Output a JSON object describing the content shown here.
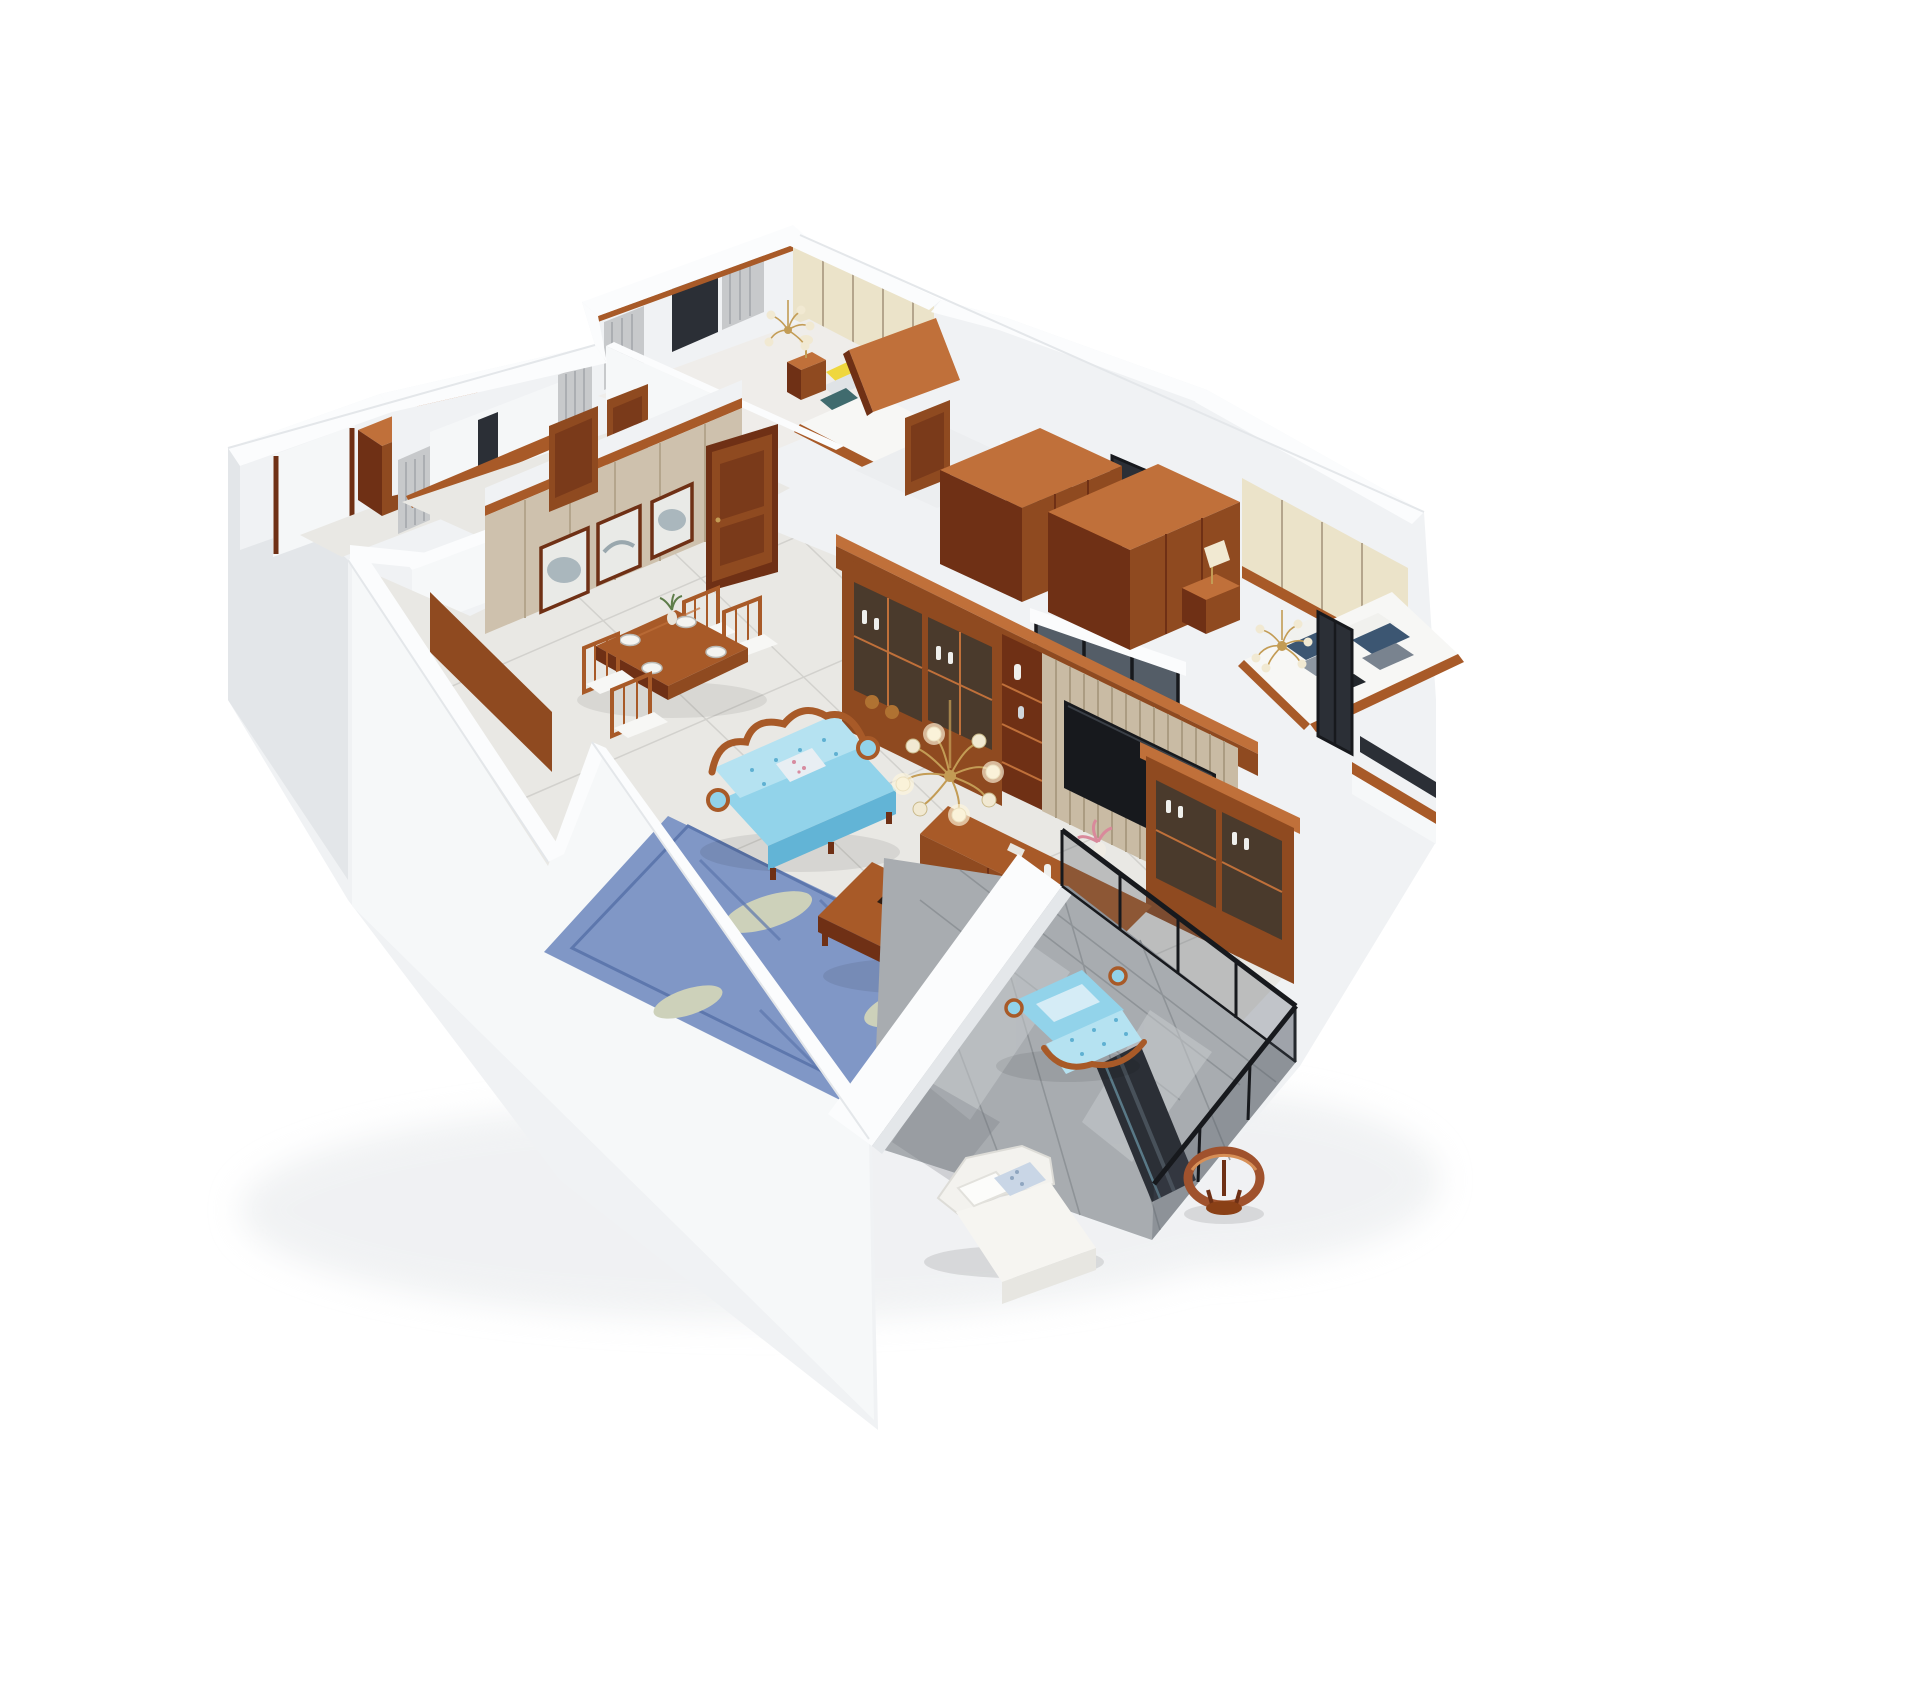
{
  "image_type": "3d-dollhouse-floorplan-render",
  "colors": {
    "bg": "#ffffff",
    "wallFace": "#f0f2f4",
    "wallFaceBright": "#f6f8f9",
    "wallShade": "#e3e6e9",
    "wallDark": "#d5d9dc",
    "cap": "#fbfcfd",
    "capEdge": "#e4e7ea",
    "floorLight": "#e9e8e4",
    "floorWarm": "#efedea",
    "tileLine": "#d2d1cd",
    "balconyTile": "#a8acb0",
    "balconyTileDark": "#888d92",
    "balconyTileLight": "#c9cdd0",
    "woodDark": "#6f3015",
    "wood": "#8f4a20",
    "woodMid": "#a85a28",
    "woodLight": "#c0703a",
    "woodPale": "#d79057",
    "panelBeige": "#cec1ad",
    "panelBeigeDark": "#b4a58c",
    "slat": "#c9bba4",
    "slatLine": "#ab9c82",
    "cream": "#ebe3c9",
    "curtain": "#c7c9cb",
    "curtainDark": "#abaeb2",
    "glassBright": "#f5f7f8",
    "glassDark": "#2b2f36",
    "glassTint": "#47505a",
    "black": "#17191d",
    "sofaBlue": "#92d3ea",
    "sofaBlueLight": "#b5e2f1",
    "sofaBlueDark": "#62b4d6",
    "rugBlue": "#8097c6",
    "rugBlueDark": "#5d77ad",
    "rugLeaf": "#cdd1ba",
    "white": "#f7f7f5",
    "pillowNavy": "#3c5672",
    "pillowGray": "#8d97a2",
    "pillowYellow": "#efd73e",
    "pillowTeal": "#406b6e",
    "gold": "#c39c55",
    "lampCream": "#f1e9d2",
    "artMist": "#aab7bd",
    "plantGreen": "#5e7d4a",
    "pink": "#d9899b",
    "shadow": "#e2e5e8"
  },
  "scene": {
    "style": "american-classic-wood-interior",
    "rooms": [
      {
        "id": "bedroom-north",
        "furniture": [
          "double-bed",
          "yellow-pillow",
          "nightstand",
          "table-lamp",
          "chandelier",
          "wardrobe-top",
          "window",
          "curtains",
          "cream-panel-wall"
        ]
      },
      {
        "id": "bedroom-west",
        "furniture": [
          "window",
          "curtains",
          "wood-window-sill"
        ]
      },
      {
        "id": "west-balcony",
        "furniture": [
          "wall-cabinet",
          "bright-window"
        ]
      },
      {
        "id": "hallway",
        "furniture": [
          "wood-door-bedroom",
          "wood-door-dining"
        ]
      },
      {
        "id": "bathroom-a",
        "furniture": [
          "glass-partition"
        ]
      },
      {
        "id": "bathroom-b",
        "furniture": [
          "glass-partition",
          "small-window"
        ]
      },
      {
        "id": "master-bedroom",
        "furniture": [
          "wardrobe-left",
          "wardrobe-right",
          "headboard-panel-wall",
          "double-bed",
          "pillows",
          "nightstand",
          "table-lamp",
          "chandelier",
          "window-bay",
          "east-bay-window"
        ]
      },
      {
        "id": "dining-room",
        "furniture": [
          "dining-table",
          "four-chairs",
          "three-wall-art-frames",
          "entry-door",
          "side-door"
        ]
      },
      {
        "id": "living-room",
        "furniture": [
          "tv-wall-cabinet",
          "display-cabinet-left",
          "display-cabinet-right",
          "tv",
          "slat-panel",
          "tv-console",
          "blue-sofa",
          "blue-armchair",
          "coffee-table",
          "chessboard",
          "blue-leaf-rug",
          "chandelier"
        ]
      },
      {
        "id": "south-balcony",
        "furniture": [
          "lounge-chair",
          "round-wood-stool",
          "glass-railing",
          "glossy-tile-floor",
          "dark-glass-door"
        ]
      }
    ]
  }
}
